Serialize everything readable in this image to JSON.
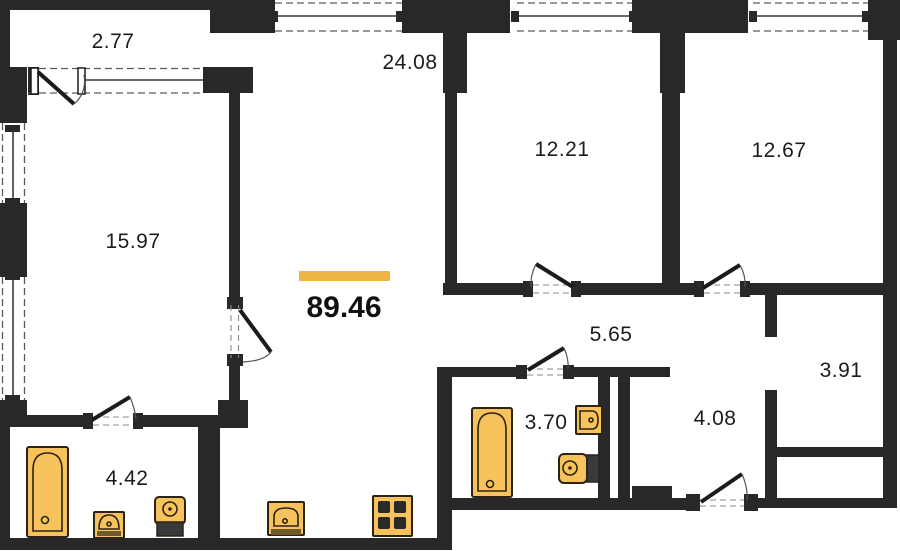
{
  "floor_plan": {
    "type": "apartment-floor-plan",
    "total": {
      "area": "89.46"
    },
    "rooms": [
      {
        "name": "balcony",
        "area": "2.77"
      },
      {
        "name": "kitchen-living-room",
        "area": "24.08"
      },
      {
        "name": "bedroom-1",
        "area": "12.21"
      },
      {
        "name": "bedroom-2",
        "area": "12.67"
      },
      {
        "name": "room",
        "area": "15.97"
      },
      {
        "name": "hallway",
        "area": "5.65"
      },
      {
        "name": "storage",
        "area": "3.91"
      },
      {
        "name": "bathroom",
        "area": "3.70"
      },
      {
        "name": "corridor",
        "area": "4.08"
      },
      {
        "name": "bathroom-2",
        "area": "4.42"
      }
    ],
    "colors": {
      "wall": "#282828",
      "accent": "#F0B545",
      "fixture_fill": "#F5C25C",
      "fixture_outline": "#2C2315",
      "background": "#FFFFFF"
    },
    "icons": [
      "bathtub-icon",
      "sink-icon",
      "toilet-icon",
      "kitchen-sink-icon",
      "stove-icon",
      "bathtub-icon",
      "sink-icon",
      "toilet-icon",
      "door-swing-icon",
      "window-icon"
    ]
  }
}
